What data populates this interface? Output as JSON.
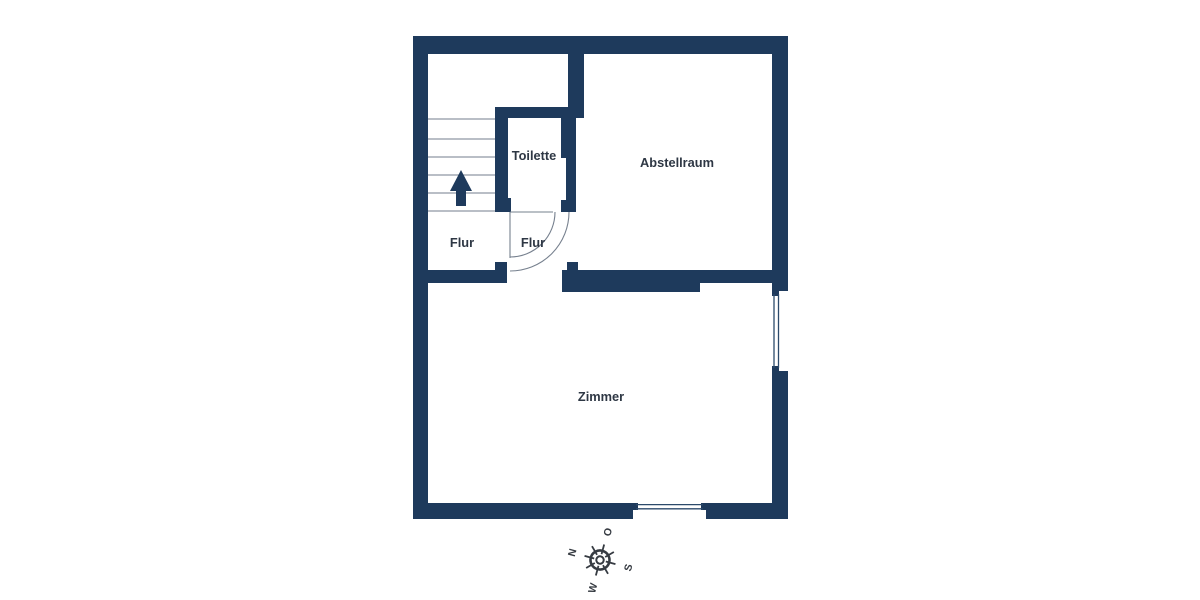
{
  "floorplan": {
    "rooms": {
      "toilette": "Toilette",
      "abstellraum": "Abstellraum",
      "flur_left": "Flur",
      "flur_right": "Flur",
      "zimmer": "Zimmer"
    },
    "features": {
      "stair_tread_count": 6,
      "windows": [
        "right-wall-window",
        "bottom-wall-window"
      ],
      "doors": [
        "toilette-door",
        "abstellraum-door"
      ]
    }
  },
  "compass": {
    "north": "N",
    "east": "O",
    "south": "S",
    "west": "W"
  },
  "colors": {
    "wall": "#1e3a5c",
    "label_text": "#2e3744",
    "stair_line": "#8f98a3",
    "door_line": "#76808e",
    "glazing": "#2c4a6b",
    "compass": "#363b42",
    "background": "#ffffff"
  }
}
